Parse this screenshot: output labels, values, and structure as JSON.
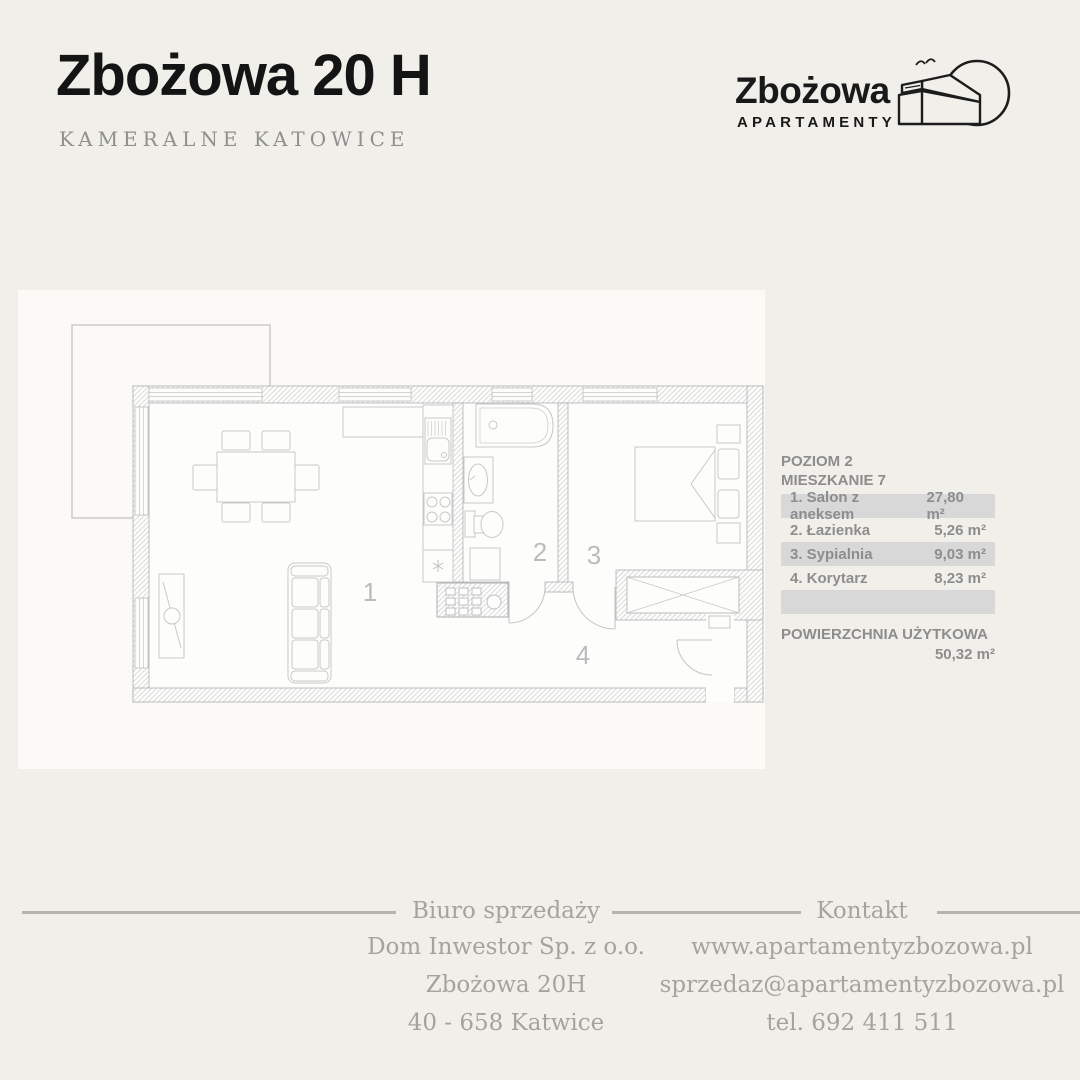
{
  "header": {
    "title": "Zbożowa 20 H",
    "subtitle": "KAMERALNE KATOWICE"
  },
  "logo": {
    "name": "Zbożowa",
    "tagline": "APARTAMENTY",
    "icon": "building-sun-icon"
  },
  "unit_info": {
    "level_label": "POZIOM 2",
    "unit_label": "MIESZKANIE 7",
    "rooms": [
      {
        "name": "1. Salon z aneksem",
        "area": "27,80 m²"
      },
      {
        "name": "2. Łazienka",
        "area": "5,26 m²"
      },
      {
        "name": "3. Sypialnia",
        "area": "9,03 m²"
      },
      {
        "name": "4. Korytarz",
        "area": "8,23 m²"
      }
    ],
    "total_label": "POWIERZCHNIA UŻYTKOWA",
    "total_area": "50,32 m²"
  },
  "floorplan": {
    "room_numbers": [
      "1",
      "2",
      "3",
      "4"
    ]
  },
  "footer": {
    "office": {
      "heading": "Biuro sprzedaży",
      "lines": [
        "Dom Inwestor Sp. z o.o.",
        "Zbożowa 20H",
        "40 - 658 Katwice"
      ]
    },
    "contact": {
      "heading": "Kontakt",
      "lines": [
        "www.apartamentyzbozowa.pl",
        "sprzedaz@apartamentyzbozowa.pl",
        "tel. 692 411 511"
      ]
    }
  },
  "colors": {
    "background": "#f1efe9",
    "panel": "#fbfaf6",
    "table_row_gray": "#d8d8d8",
    "table_text": "#8d8d8d",
    "footer_text": "#a6a39d",
    "title_text": "#141414"
  }
}
